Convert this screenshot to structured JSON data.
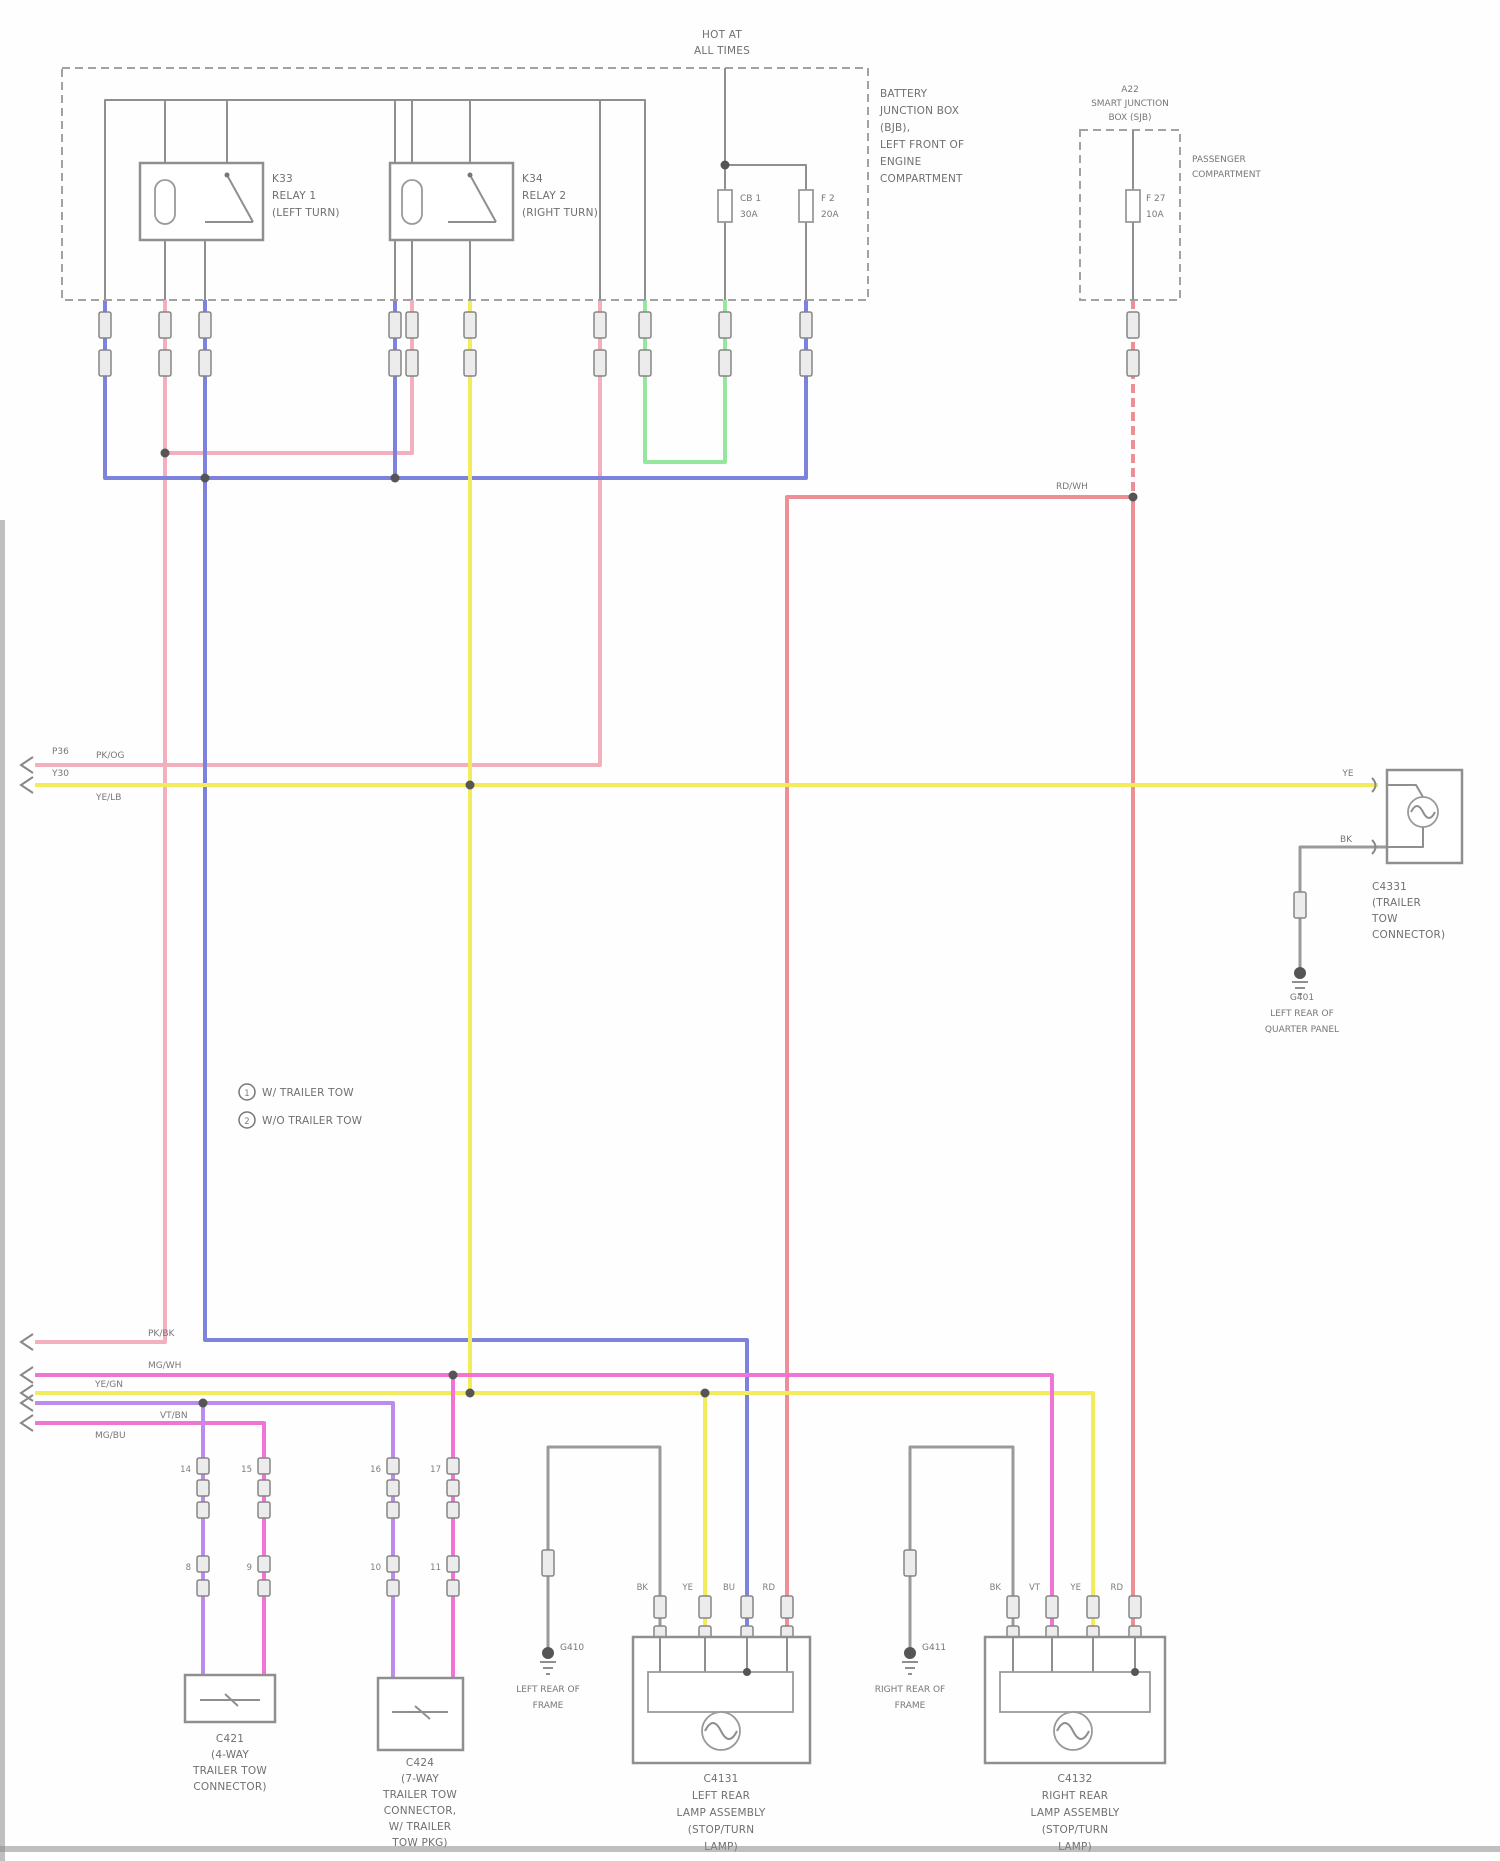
{
  "colors": {
    "pink": "#F3AFBC",
    "red": "#EE8F95",
    "blue": "#7D82DD",
    "yellow": "#F2EB5C",
    "green": "#97E6A0",
    "magenta": "#F273D6",
    "violet": "#BC8BEC",
    "gray": "#9A9A9A"
  },
  "power_box": {
    "hot": [
      "HOT AT",
      "ALL TIMES"
    ],
    "annotation": [
      "BATTERY",
      "JUNCTION BOX",
      "(BJB),",
      "LEFT FRONT OF",
      "ENGINE",
      "COMPARTMENT"
    ],
    "relay1": {
      "code": "K33",
      "name": "RELAY 1",
      "detail": "(LEFT TURN)"
    },
    "relay2": {
      "code": "K34",
      "name": "RELAY 2",
      "detail": "(RIGHT TURN)"
    },
    "breaker": {
      "id": "CB 1",
      "amps": "30A"
    },
    "fuse": {
      "id": "F 2",
      "amps": "20A"
    }
  },
  "sjb": {
    "title": [
      "A22",
      "SMART JUNCTION",
      "BOX (SJB)"
    ],
    "annotation": [
      "PASSENGER",
      "COMPARTMENT"
    ],
    "fuse": {
      "id": "F 27",
      "amps": "10A"
    }
  },
  "wire_codes": {
    "red_bus": "RD/WH",
    "pink_upper": "PK/OG",
    "yellow_upper": "YE/LB",
    "upper_conn_1": "P36",
    "upper_conn_2": "Y30",
    "pink_lower": "PK/BK",
    "magenta_lower": "MG/WH",
    "yellow_lower": "YE/GN",
    "violet_lower": "VT/BN",
    "magenta2_lower": "MG/BU"
  },
  "legend": {
    "items": [
      {
        "num": "1",
        "text": "W/ TRAILER TOW"
      },
      {
        "num": "2",
        "text": "W/O TRAILER TOW"
      }
    ]
  },
  "inline_connectors": {
    "pairs": [
      [
        "14",
        "8"
      ],
      [
        "15",
        "9"
      ],
      [
        "16",
        "10"
      ],
      [
        "17",
        "11"
      ]
    ]
  },
  "components": {
    "trailer4": {
      "lines": [
        "C421",
        "(4-WAY",
        "TRAILER TOW",
        "CONNECTOR)"
      ]
    },
    "trailer7": {
      "lines": [
        "C424",
        "(7-WAY",
        "TRAILER TOW",
        "CONNECTOR,",
        "W/ TRAILER",
        "TOW PKG)"
      ]
    },
    "left_rear": {
      "pins": [
        "BK",
        "YE",
        "BU",
        "RD"
      ],
      "lines": [
        "C4131",
        "LEFT REAR",
        "LAMP ASSEMBLY",
        "(STOP/TURN",
        "LAMP)"
      ]
    },
    "right_rear": {
      "pins": [
        "BK",
        "VT",
        "YE",
        "RD"
      ],
      "lines": [
        "C4132",
        "RIGHT REAR",
        "LAMP ASSEMBLY",
        "(STOP/TURN",
        "LAMP)"
      ]
    },
    "tow_conn": {
      "feed": "YE",
      "gnd": "BK",
      "note": [
        "C4331",
        "(TRAILER",
        "TOW",
        "CONNECTOR)"
      ]
    }
  },
  "grounds": {
    "g410": {
      "code": "G410",
      "lines": [
        "LEFT REAR OF",
        "FRAME"
      ]
    },
    "g411": {
      "code": "G411",
      "lines": [
        "RIGHT REAR OF",
        "FRAME"
      ]
    },
    "g401": {
      "code": "G401",
      "lines": [
        "LEFT REAR OF",
        "QUARTER PANEL"
      ]
    }
  }
}
